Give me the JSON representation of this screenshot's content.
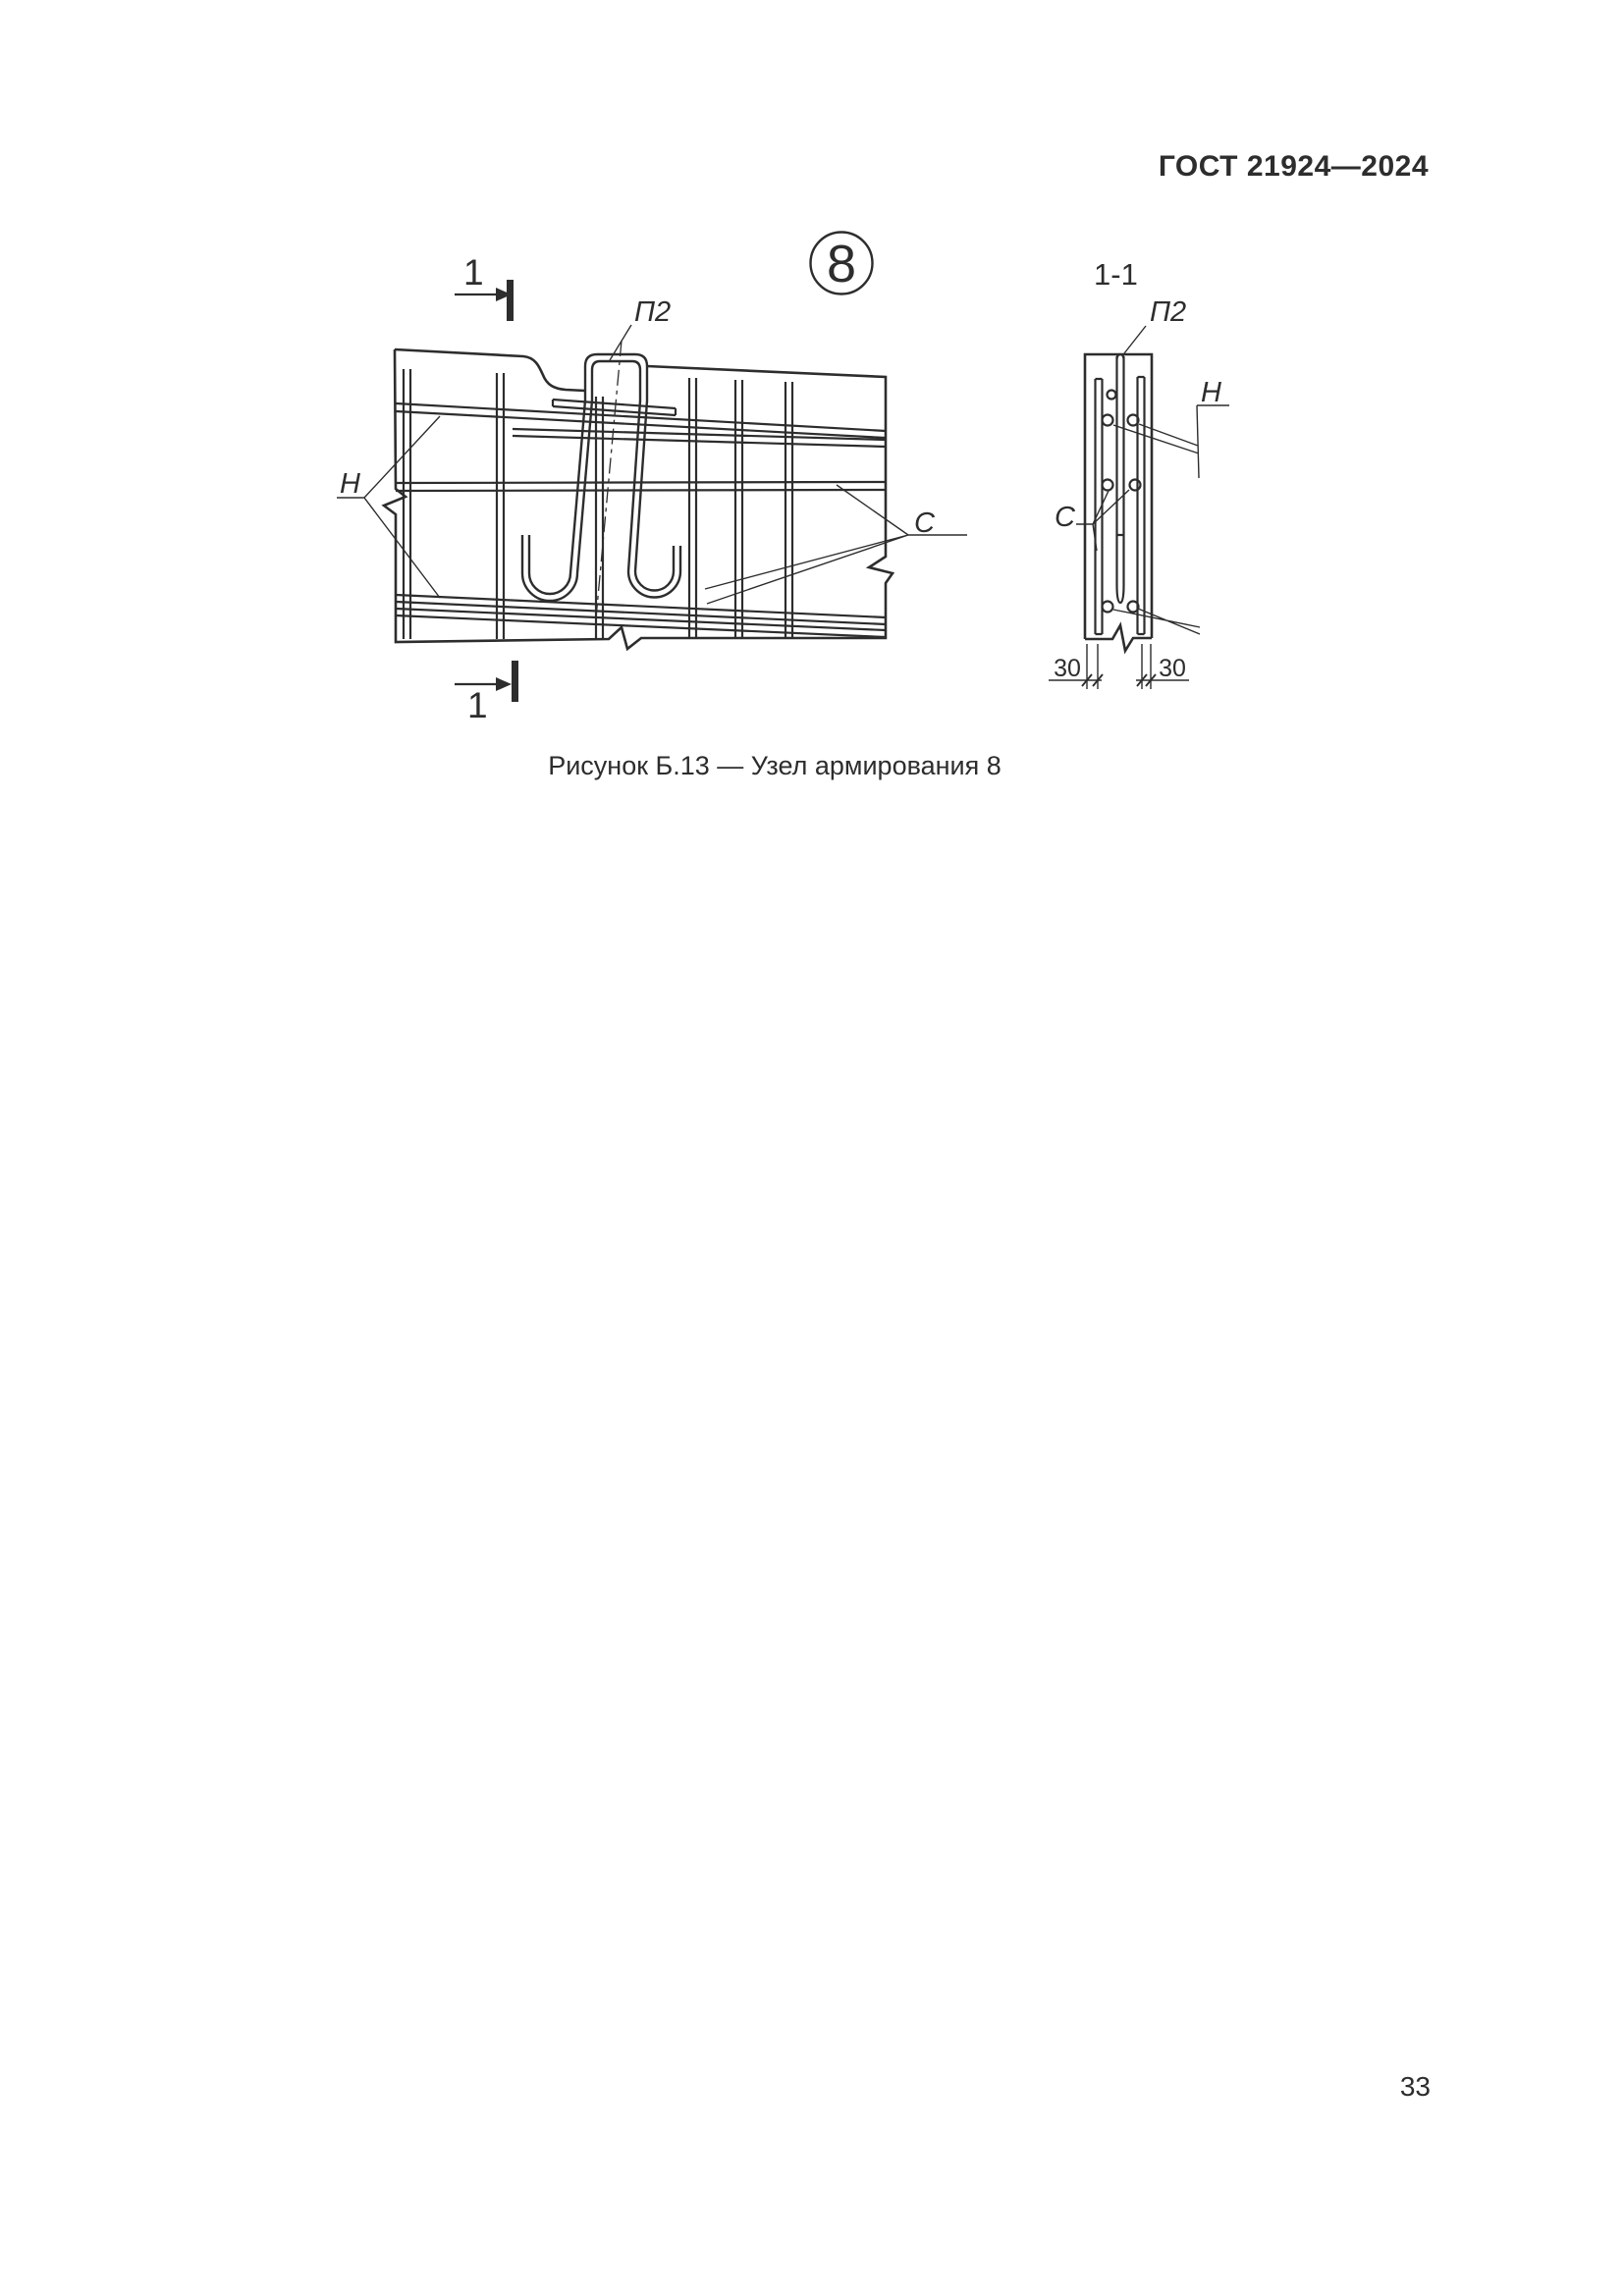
{
  "page": {
    "header": "ГОСТ 21924—2024",
    "caption": "Рисунок Б.13 — Узел армирования 8",
    "page_number": "33"
  },
  "figure": {
    "detail_number": "8",
    "line_color": "#2d2d2d",
    "section_cut": {
      "top_label": "1",
      "bottom_label": "1"
    },
    "main_view": {
      "hairpin_label": "П2",
      "bars_label": "Н",
      "mesh_label": "С"
    },
    "section_view": {
      "title": "1-1",
      "hairpin_label": "П2",
      "bars_label": "Н",
      "mesh_label": "С",
      "dim_left": "30",
      "dim_right": "30"
    }
  }
}
